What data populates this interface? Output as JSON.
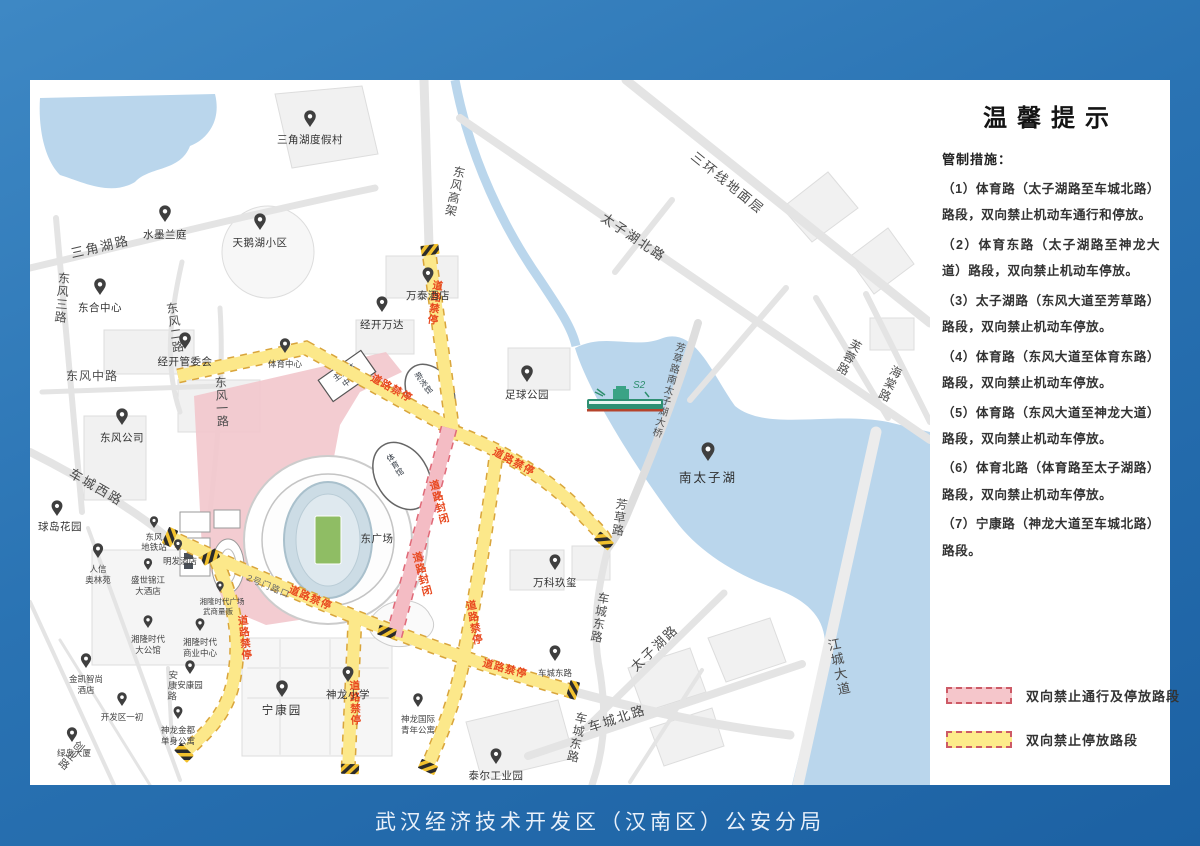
{
  "page": {
    "footer": "武汉经济技术开发区（汉南区）公安分局"
  },
  "panel": {
    "title": "温馨提示",
    "intro": "管制措施：",
    "items": [
      "（1）体育路（太子湖路至车城北路）路段，双向禁止机动车通行和停放。",
      "（2）体育东路（太子湖路至神龙大道）路段，双向禁止机动车停放。",
      "（3）太子湖路（东风大道至芳草路）路段，双向禁止机动车停放。",
      "（4）体育路（东风大道至体育东路）路段，双向禁止机动车停放。",
      "（5）体育路（东风大道至神龙大道）路段，双向禁止机动车停放。",
      "（6）体育北路（体育路至太子湖路）路段，双向禁止机动车停放。",
      "（7）宁康路（神龙大道至车城北路）路段。"
    ],
    "legend": [
      {
        "label": "双向禁止通行及停放路段",
        "fill": "#f5c6cb",
        "border": "#cd5a66"
      },
      {
        "label": "双向禁止停放路段",
        "fill": "#fdeb8a",
        "border": "#cd5a66"
      }
    ]
  },
  "map": {
    "colors": {
      "water": "#bad6ec",
      "no_parking_road": "#fce88a",
      "no_parking_casing": "#d9a53c",
      "closed_road": "#f4bcc4",
      "closed_casing": "#e06a78",
      "control_text": "#e8481f",
      "road_gray": "#e4e4e4",
      "pink_zone": "#f2c7cc",
      "pitch_green": "#8fbd64"
    },
    "labels": {
      "sanhuan": "三环线地面层",
      "taizihu_north": "太子湖北路",
      "furong": "芙蓉路",
      "haitang": "海棠路",
      "bridge": "芳草路南太子湖大桥",
      "fangcao": "芳草路",
      "jiangcheng": "江城大道",
      "dongfeng_gaojia": "东风高架",
      "sanjiaohu_rd": "三角湖路",
      "dongfeng3": "东风三路",
      "dongfeng2": "东风二路",
      "dongfeng_mid": "东风中路",
      "dongfeng1": "东风一路",
      "checheng_west": "车城西路",
      "checheng_north": "车城北路",
      "checheng_east": "车城东路",
      "taizihu_rd": "太子湖路",
      "ankang_rd": "安康路",
      "chuangye_rd": "创业路",
      "no_parking": "道路禁停",
      "road_closed": "道路封闭",
      "junction": "2号门路口"
    },
    "pois": {
      "sanjiaohu_resort": "三角湖度假村",
      "shuimo_lanting": "水墨兰庭",
      "tianehu": "天鹅湖小区",
      "donghe_center": "东合中心",
      "wantai_hotel": "万泰酒店",
      "jingkai_wanda": "经开万达",
      "jingkai_guanweihui": "经开管委会",
      "dongfeng_company": "东风公司",
      "sports_center": "体育中心",
      "football_park": "足球公园",
      "nan_taizihu": "南太子湖",
      "wanke_jiuxi": "万科玖玺",
      "ningkang_garden": "宁康园",
      "shenlong_primary": "神龙小学",
      "shenlong_intl_l1": "神龙国际",
      "shenlong_intl_l2": "青年公寓",
      "taier_park": "泰尔工业园",
      "renxin_l1": "人信",
      "renxin_l2": "奥林苑",
      "mingfa_hotel": "明发酒店",
      "shengshi_l1": "盛世锦江",
      "shengshi_l2": "大酒店",
      "metro_l1": "东风",
      "metro_l2": "地铁站",
      "xianglong_plaza": "湘隆时代广场",
      "wushang": "武商量贩",
      "xl_mansion_l1": "湘隆时代",
      "xl_mansion_l2": "大公馆",
      "xl_biz_l1": "湘隆时代",
      "xl_biz_l2": "商业中心",
      "jinkai_l1": "金凯智尚",
      "jinkai_l2": "酒店",
      "ankang_garden": "安康园",
      "kaifaqu_yichu": "开发区一初",
      "sl_apt_l1": "神龙金都",
      "sl_apt_l2": "单身公寓",
      "lvdao": "绿岛大厦",
      "qiudao_garden": "球岛花园"
    },
    "stadium": {
      "east_plaza": "东广场",
      "gym": "体育馆",
      "natatorium": "游泳馆",
      "media_l1": "主媒体",
      "media_l2": "中心"
    },
    "ship_label": "S2"
  }
}
